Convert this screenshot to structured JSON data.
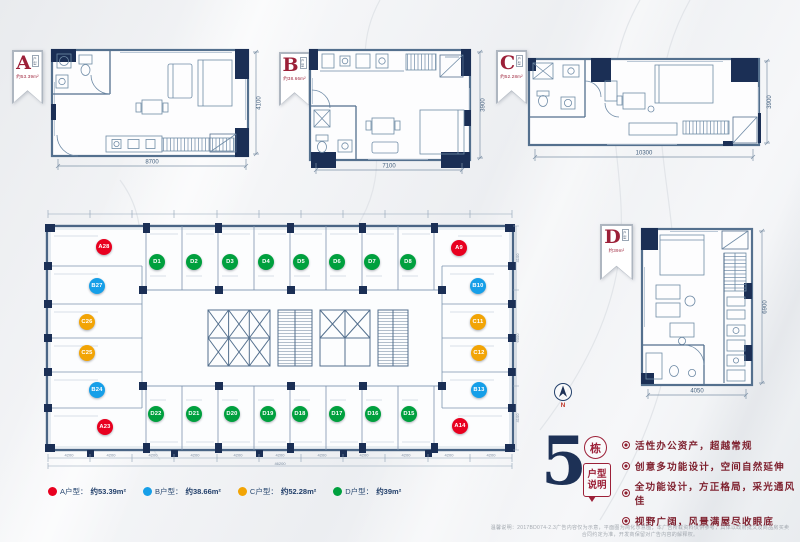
{
  "banners": {
    "A": {
      "letter": "A",
      "tag": "户型",
      "area": "约53.39m²"
    },
    "B": {
      "letter": "B",
      "tag": "户型",
      "area": "约38.66m²"
    },
    "C": {
      "letter": "C",
      "tag": "户型",
      "area": "约52.28m²"
    },
    "D": {
      "letter": "D",
      "tag": "户型",
      "area": "约39m²"
    }
  },
  "plans": {
    "A": {
      "width_dim": "8700",
      "height_dim": "4100"
    },
    "B": {
      "width_dim": "7100",
      "height_dim": "3900"
    },
    "C": {
      "width_dim": "10300",
      "height_dim": "3900"
    },
    "D": {
      "width_dim": "4050",
      "height_dim": "6900"
    }
  },
  "floor_plate": {
    "top_units": [
      "D1",
      "D2",
      "D3",
      "D4",
      "D5",
      "D6",
      "D7",
      "D8"
    ],
    "right_units": [
      "A9",
      "B10",
      "C11",
      "C12",
      "B13",
      "A14"
    ],
    "bottom_units": [
      "D22",
      "D21",
      "D20",
      "D19",
      "D18",
      "D17",
      "D16",
      "D15"
    ],
    "left_units": [
      "A28",
      "B27",
      "C26",
      "C25",
      "B24",
      "A23"
    ],
    "unit_colors": {
      "A": "#e8001f",
      "B": "#169fe8",
      "C": "#f2a405",
      "D": "#00a03e"
    },
    "dims": {
      "bottom": [
        "4200",
        "4200",
        "4200",
        "4200",
        "4200",
        "4200",
        "4200",
        "4200",
        "4200",
        "4200",
        "4200"
      ],
      "bottom_total": "46200",
      "right": [
        "4100",
        "6000",
        "4100"
      ]
    }
  },
  "legend": {
    "items": [
      {
        "color": "#e8001f",
        "label": "A户型：",
        "area": "约53.39m²"
      },
      {
        "color": "#169fe8",
        "label": "B户型：",
        "area": "约38.66m²"
      },
      {
        "color": "#f2a405",
        "label": "C户型：",
        "area": "约52.28m²"
      },
      {
        "color": "#00a03e",
        "label": "D户型：",
        "area": "约39m²"
      }
    ]
  },
  "building_info": {
    "number": "5",
    "number_tag": "栋",
    "bubble_line1": "户型",
    "bubble_line2": "说明",
    "bullets": [
      "活性办公资产，超越常规",
      "创意多功能设计，空间自然延伸",
      "全功能设计，方正格局，采光通风佳",
      "视野广阔，风景满屋尽收眼底"
    ]
  },
  "compass": {
    "label": "N"
  },
  "disclaimer": "温馨说明：2017BD074-2.3广告内容仅为示意，平面图为简化示意图；本广告所载资料仅供参考，具体以政府批文及商品房买卖合同约定为准，开发商保留对广告内容的解释权。"
}
